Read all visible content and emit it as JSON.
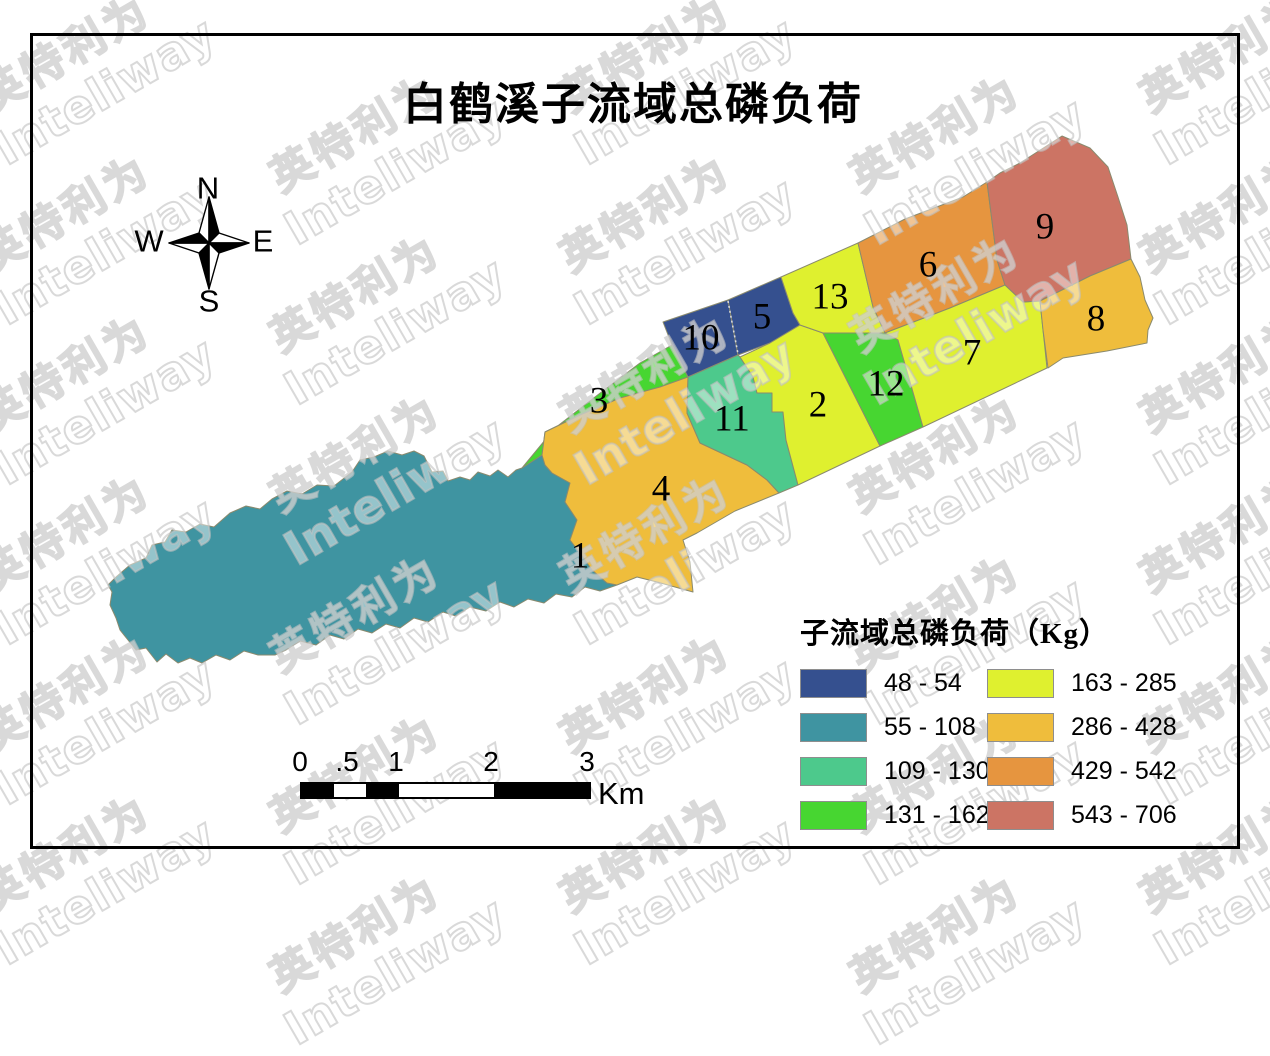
{
  "title": "白鹤溪子流域总磷负荷",
  "compass": {
    "n": "N",
    "e": "E",
    "s": "S",
    "w": "W"
  },
  "map": {
    "regions": [
      {
        "id": 1,
        "label": "1",
        "color": "#3F94A1"
      },
      {
        "id": 2,
        "label": "2",
        "color": "#DFF02F"
      },
      {
        "id": 3,
        "label": "3",
        "color": "#47D631"
      },
      {
        "id": 4,
        "label": "4",
        "color": "#EFBD3C"
      },
      {
        "id": 5,
        "label": "5",
        "color": "#35508F"
      },
      {
        "id": 6,
        "label": "6",
        "color": "#E6953F"
      },
      {
        "id": 7,
        "label": "7",
        "color": "#DFF02F"
      },
      {
        "id": 8,
        "label": "8",
        "color": "#EFBD3C"
      },
      {
        "id": 9,
        "label": "9",
        "color": "#CC7464"
      },
      {
        "id": 10,
        "label": "10",
        "color": "#35508F"
      },
      {
        "id": 11,
        "label": "11",
        "color": "#4DC98C"
      },
      {
        "id": 12,
        "label": "12",
        "color": "#47D631"
      },
      {
        "id": 13,
        "label": "13",
        "color": "#DFF02F"
      }
    ]
  },
  "legend": {
    "title": "子流域总磷负荷（Kg）",
    "items": [
      {
        "range": "48 - 54",
        "color": "#35508F"
      },
      {
        "range": "55 - 108",
        "color": "#3F94A1"
      },
      {
        "range": "109 - 130",
        "color": "#4DC98C"
      },
      {
        "range": "131 - 162",
        "color": "#47D631"
      },
      {
        "range": "163 - 285",
        "color": "#DFF02F"
      },
      {
        "range": "286 - 428",
        "color": "#EFBD3C"
      },
      {
        "range": "429 - 542",
        "color": "#E6953F"
      },
      {
        "range": "543 - 706",
        "color": "#CC7464"
      }
    ]
  },
  "scalebar": {
    "ticks": [
      "0",
      ".5",
      "1",
      "2",
      "3"
    ],
    "unit": "Km"
  },
  "watermark": {
    "cjk": "英特利为",
    "latin": "Inteliway"
  }
}
